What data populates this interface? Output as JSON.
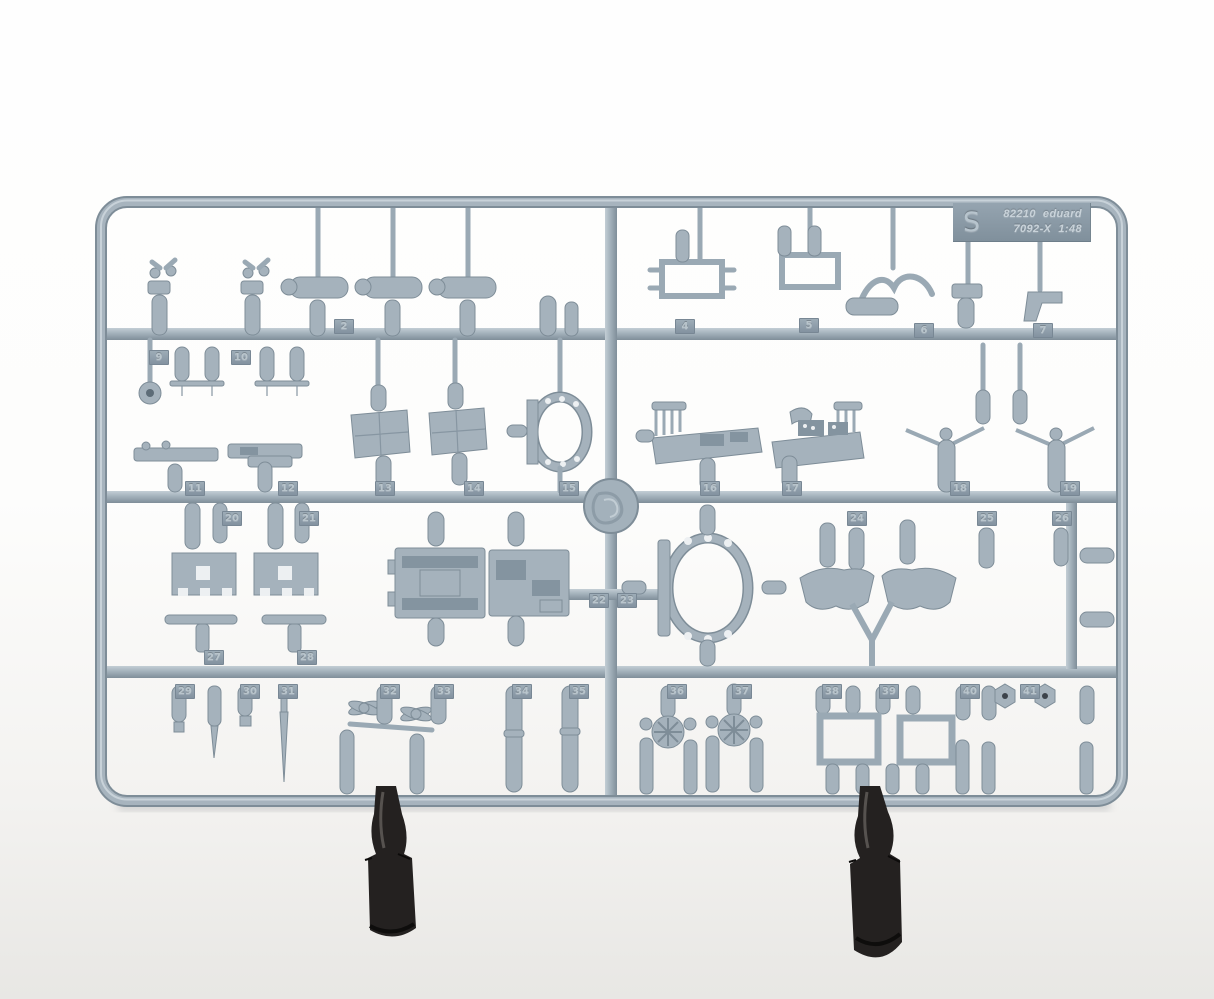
{
  "label": {
    "mold_letter": "S",
    "kit_number": "82210",
    "brand": "eduard",
    "mold_code": "7092-X",
    "scale": "1:48"
  },
  "sprue": {
    "plastic_color": "#a5b2bc",
    "plastic_highlight": "#c8d2d9",
    "plastic_shadow": "#7e8d98",
    "part_tags": [
      {
        "n": "2",
        "x": 334,
        "y": 319
      },
      {
        "n": "4",
        "x": 675,
        "y": 319
      },
      {
        "n": "5",
        "x": 799,
        "y": 318
      },
      {
        "n": "6",
        "x": 914,
        "y": 323
      },
      {
        "n": "7",
        "x": 1033,
        "y": 323
      },
      {
        "n": "9",
        "x": 149,
        "y": 350
      },
      {
        "n": "10",
        "x": 231,
        "y": 350
      },
      {
        "n": "11",
        "x": 185,
        "y": 481
      },
      {
        "n": "12",
        "x": 278,
        "y": 481
      },
      {
        "n": "13",
        "x": 375,
        "y": 481
      },
      {
        "n": "14",
        "x": 464,
        "y": 481
      },
      {
        "n": "15",
        "x": 559,
        "y": 481
      },
      {
        "n": "16",
        "x": 700,
        "y": 481
      },
      {
        "n": "17",
        "x": 782,
        "y": 481
      },
      {
        "n": "18",
        "x": 950,
        "y": 481
      },
      {
        "n": "19",
        "x": 1060,
        "y": 481
      },
      {
        "n": "20",
        "x": 222,
        "y": 511
      },
      {
        "n": "21",
        "x": 299,
        "y": 511
      },
      {
        "n": "22",
        "x": 589,
        "y": 593
      },
      {
        "n": "23",
        "x": 617,
        "y": 593
      },
      {
        "n": "24",
        "x": 847,
        "y": 511
      },
      {
        "n": "25",
        "x": 977,
        "y": 511
      },
      {
        "n": "26",
        "x": 1052,
        "y": 511
      },
      {
        "n": "27",
        "x": 204,
        "y": 650
      },
      {
        "n": "28",
        "x": 297,
        "y": 650
      },
      {
        "n": "29",
        "x": 175,
        "y": 684
      },
      {
        "n": "30",
        "x": 240,
        "y": 684
      },
      {
        "n": "31",
        "x": 278,
        "y": 684
      },
      {
        "n": "32",
        "x": 380,
        "y": 684
      },
      {
        "n": "33",
        "x": 434,
        "y": 684
      },
      {
        "n": "34",
        "x": 512,
        "y": 684
      },
      {
        "n": "35",
        "x": 569,
        "y": 684
      },
      {
        "n": "36",
        "x": 667,
        "y": 684
      },
      {
        "n": "37",
        "x": 732,
        "y": 684
      },
      {
        "n": "38",
        "x": 822,
        "y": 684
      },
      {
        "n": "39",
        "x": 879,
        "y": 684
      },
      {
        "n": "40",
        "x": 960,
        "y": 684
      },
      {
        "n": "41",
        "x": 1020,
        "y": 684
      }
    ]
  },
  "stand_clips": {
    "color": "#242120",
    "count": "2"
  }
}
